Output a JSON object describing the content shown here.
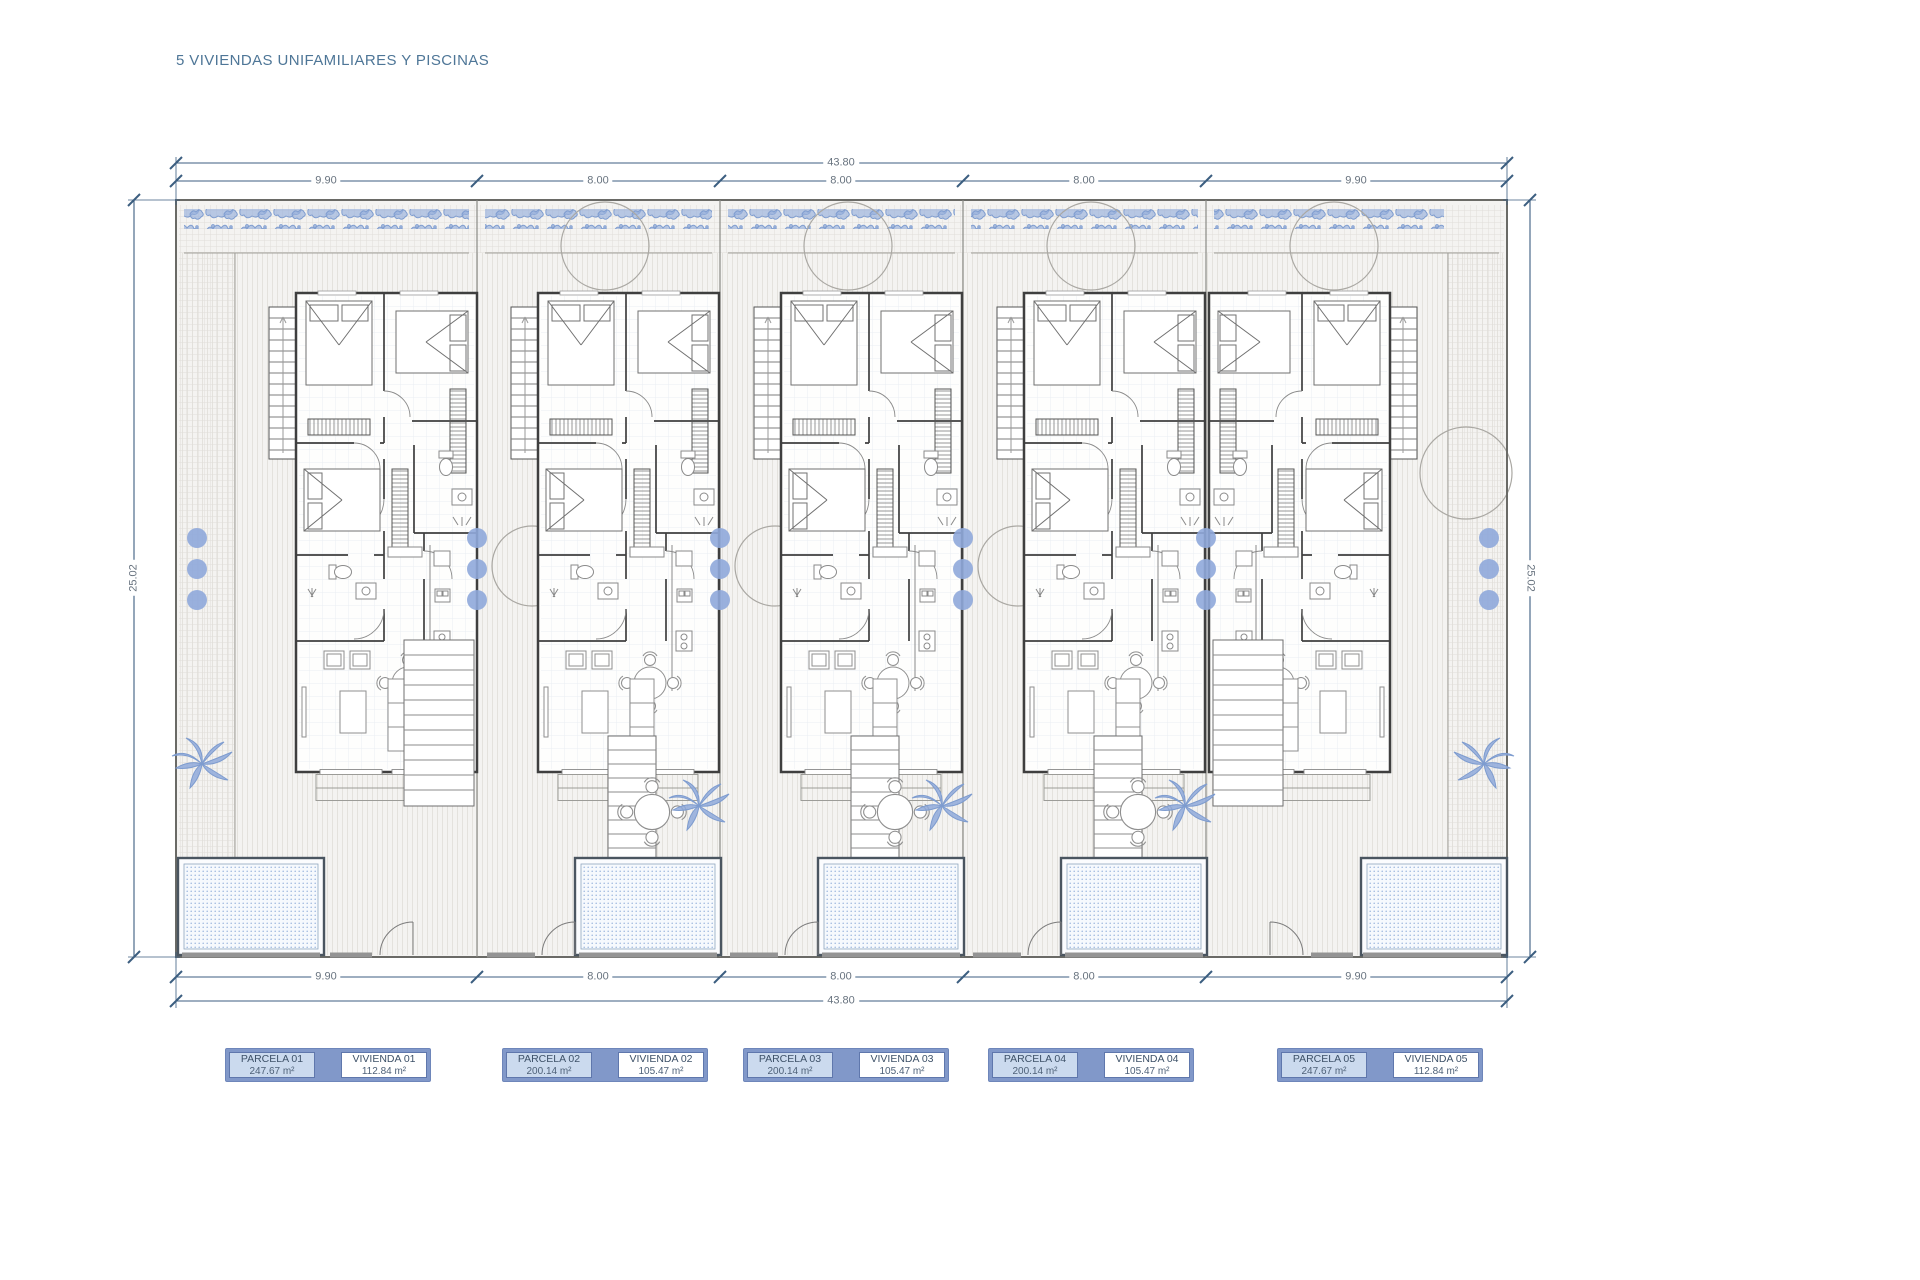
{
  "title": "5 VIVIENDAS UNIFAMILIARES Y PISCINAS",
  "dimensions": {
    "total_top": "43.80",
    "total_bottom": "43.80",
    "side_left": "25.02",
    "side_right": "25.02",
    "parcels_top": [
      "9.90",
      "8.00",
      "8.00",
      "8.00",
      "9.90"
    ],
    "parcels_bottom": [
      "9.90",
      "8.00",
      "8.00",
      "8.00",
      "9.90"
    ]
  },
  "legend": {
    "groups": [
      {
        "parcela_label": "PARCELA 01",
        "parcela_area": "247.67 m²",
        "vivienda_label": "VIVIENDA 01",
        "vivienda_area": "112.84 m²"
      },
      {
        "parcela_label": "PARCELA 02",
        "parcela_area": "200.14 m²",
        "vivienda_label": "VIVIENDA 02",
        "vivienda_area": "105.47 m²"
      },
      {
        "parcela_label": "PARCELA 03",
        "parcela_area": "200.14 m²",
        "vivienda_label": "VIVIENDA 03",
        "vivienda_area": "105.47 m²"
      },
      {
        "parcela_label": "PARCELA 04",
        "parcela_area": "200.14 m²",
        "vivienda_label": "VIVIENDA 04",
        "vivienda_area": "105.47 m²"
      },
      {
        "parcela_label": "PARCELA 05",
        "parcela_area": "247.67 m²",
        "vivienda_label": "VIVIENDA 05",
        "vivienda_area": "112.84 m²"
      }
    ]
  },
  "colors": {
    "title": "#4e7697",
    "dimension_line": "#3c5e80",
    "dimension_text": "#68737f",
    "vegetation_blue": "#89a6d6",
    "pool_dot_blue": "#9db7de",
    "legend_frame_blue": "#8198c9",
    "legend_parcela_fill": "#cbdaee",
    "wall_dark": "#3f3f3f"
  }
}
